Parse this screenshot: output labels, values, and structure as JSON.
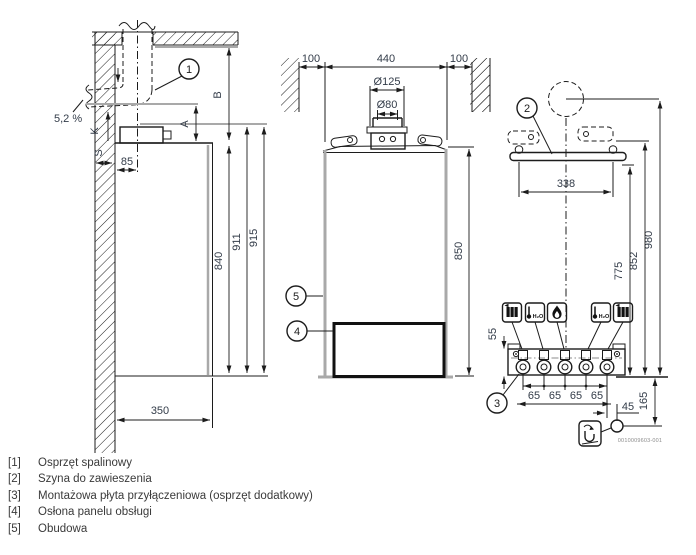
{
  "colors": {
    "line": "#1c1c1c",
    "gray_line": "#a9a9a9",
    "dim_text": "#333c49",
    "background": "#ffffff"
  },
  "side_view": {
    "slope": "5,2 %",
    "k": "K",
    "s": "S",
    "d85": "85",
    "a": "A",
    "b": "B",
    "d840": "840",
    "d911": "911",
    "d915": "915",
    "d350": "350"
  },
  "front_view": {
    "d100_left": "100",
    "d440": "440",
    "d100_right": "100",
    "d125": "Ø125",
    "d80": "Ø80",
    "d850": "850"
  },
  "rear_view": {
    "d338": "338",
    "d980": "980",
    "d852": "852",
    "d775": "775",
    "d55": "55",
    "d65_1": "65",
    "d65_2": "65",
    "d65_3": "65",
    "d65_4": "65",
    "d45": "45",
    "d165": "165",
    "code": "0010009603-001",
    "hot_water_label": "H₂O",
    "cold_water_label": "H₂O"
  },
  "callouts": {
    "c1": "1",
    "c2": "2",
    "c3": "3",
    "c4": "4",
    "c5": "5"
  },
  "legend": {
    "items": [
      {
        "index": "[1]",
        "label": "Osprzęt spalinowy"
      },
      {
        "index": "[2]",
        "label": "Szyna do zawieszenia"
      },
      {
        "index": "[3]",
        "label": "Montażowa płyta przyłączeniowa (osprzęt dodatkowy)"
      },
      {
        "index": "[4]",
        "label": "Osłona panelu obsługi"
      },
      {
        "index": "[5]",
        "label": "Obudowa"
      }
    ]
  }
}
